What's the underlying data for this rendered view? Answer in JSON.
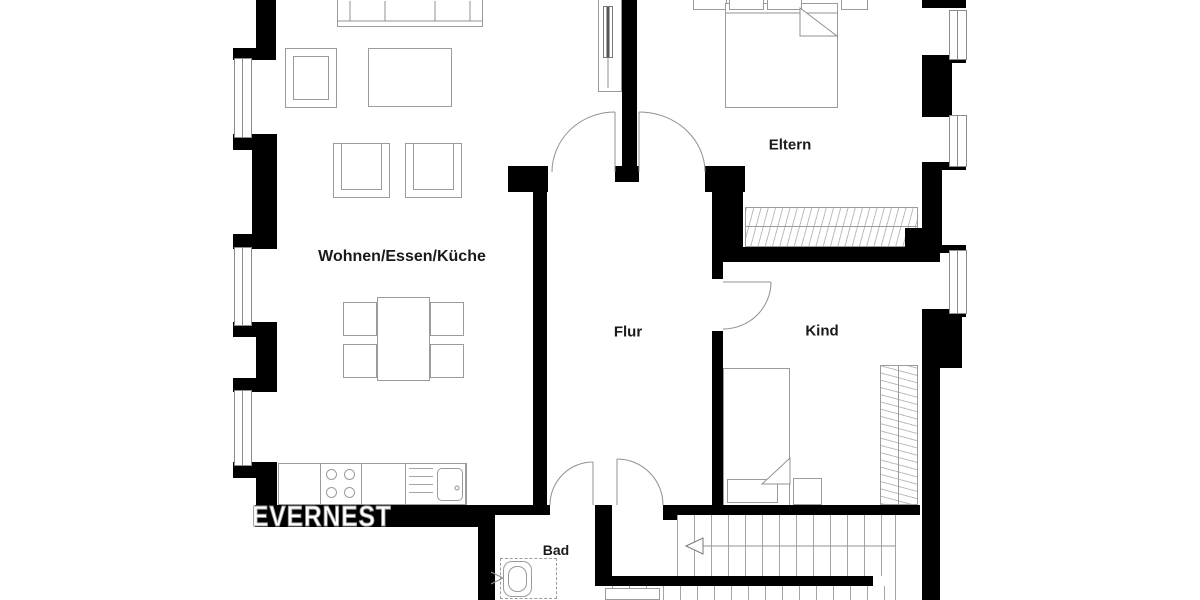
{
  "watermark": "EVERNEST",
  "rooms": {
    "living": {
      "label": "Wohnen/Essen/Küche"
    },
    "parents": {
      "label": "Eltern"
    },
    "hall": {
      "label": "Flur"
    },
    "child": {
      "label": "Kind"
    },
    "bath": {
      "label": "Bad"
    }
  },
  "colors": {
    "wall": "#000000",
    "line": "#9b9b9b",
    "hatch": "#bcbcbc",
    "label_ink": "#1a1a1a",
    "watermark_fill": "#ffffff",
    "watermark_outline": "#8f8f8f"
  }
}
